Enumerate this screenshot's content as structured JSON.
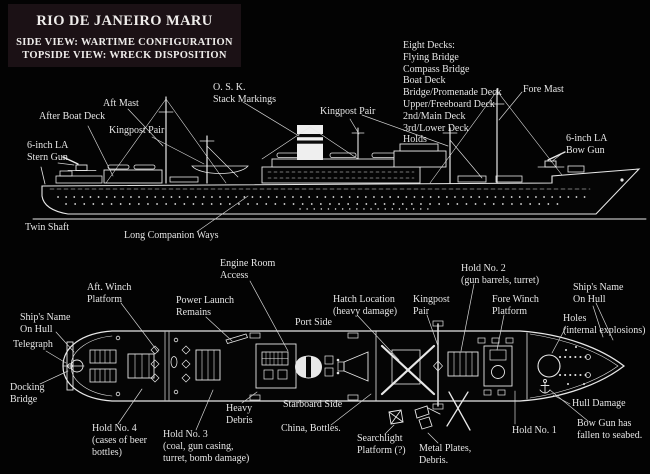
{
  "title_box": {
    "title": "RIO DE JANEIRO MARU",
    "line1": "SIDE VIEW:  WARTIME CONFIGURATION",
    "line2": "TOPSIDE VIEW:  WRECK DISPOSITION"
  },
  "colors": {
    "background": "#030303",
    "ink": "#e8e8e8",
    "title_box_bg": "#1b1115"
  },
  "side_view": {
    "deck_list": {
      "heading": "Eight Decks:",
      "items": [
        "Flying Bridge",
        "Compass Bridge",
        "Boat Deck",
        "Bridge/Promenade Deck",
        "Upper/Freeboard Deck",
        "2nd/Main Deck",
        "3rd/Lower Deck",
        "Holds"
      ]
    },
    "labels": {
      "after_boat_deck": "After Boat Deck",
      "aft_mast": "Aft Mast",
      "kingpost_pair_aft": "Kingpost Pair",
      "osk_stack_markings": [
        "O. S. K.",
        "Stack Markings"
      ],
      "kingpost_pair_mid": "Kingpost Pair",
      "fore_mast": "Fore Mast",
      "stern_gun": [
        "6-inch LA",
        "Stern Gun"
      ],
      "bow_gun": [
        "6-inch LA",
        "Bow Gun"
      ],
      "twin_shaft": "Twin Shaft",
      "long_companion_ways": "Long Companion Ways"
    }
  },
  "topside_view": {
    "labels": {
      "engine_room_access": [
        "Engine Room",
        "Access"
      ],
      "aft_winch_platform": [
        "Aft. Winch",
        "Platform"
      ],
      "power_launch_remains": [
        "Power Launch",
        "Remains"
      ],
      "hatch_location": [
        "Hatch Location",
        "(heavy damage)"
      ],
      "kingpost_pair": [
        "Kingpost",
        "Pair"
      ],
      "hold_no_2": [
        "Hold No. 2",
        "(gun barrels, turret)"
      ],
      "fore_winch_platform": [
        "Fore Winch",
        "Platform"
      ],
      "ships_name_on_hull_bow": [
        "Ship's Name",
        "On Hull"
      ],
      "holes_internal": [
        "Holes",
        "(internal explosions)"
      ],
      "port_side": "Port Side",
      "ships_name_on_hull_stern": [
        "Ship's Name",
        "On Hull"
      ],
      "telegraph": "Telegraph",
      "docking_bridge": [
        "Docking",
        "Bridge"
      ],
      "hold_no_4": [
        "Hold No. 4",
        "(cases of beer",
        "bottles)"
      ],
      "hold_no_3": [
        "Hold No. 3",
        "(coal, gun casing,",
        "turret, bomb damage)"
      ],
      "heavy_debris": [
        "Heavy",
        "Debris"
      ],
      "starboard_side": "Starboard Side",
      "china_bottles": "China, Bottles.",
      "searchlight_platform": [
        "Searchlight",
        "Platform (?)"
      ],
      "metal_plates_debris": [
        "Metal Plates,",
        "Debris."
      ],
      "hold_no_1": "Hold No. 1",
      "hull_damage": "Hull Damage",
      "bow_gun_fallen": [
        "Bow Gun has",
        "fallen to seabed."
      ]
    }
  }
}
